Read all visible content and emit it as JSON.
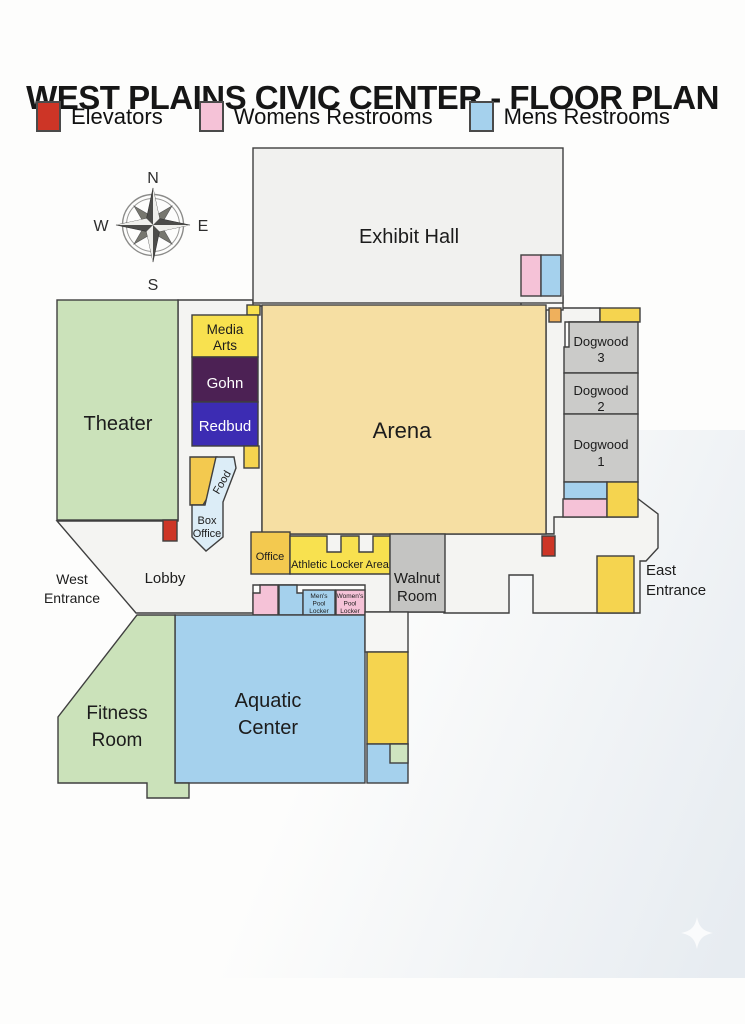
{
  "title": "WEST PLAINS CIVIC CENTER - FLOOR PLAN",
  "legend": {
    "items": [
      {
        "label": "Elevators",
        "color": "#cd3526"
      },
      {
        "label": "Womens Restrooms",
        "color": "#f5c2d7"
      },
      {
        "label": "Mens Restrooms",
        "color": "#a5d1ed"
      }
    ]
  },
  "compass": {
    "north": "N",
    "south": "S",
    "east": "E",
    "west": "W"
  },
  "floorplan": {
    "stroke": "#3f3f3f",
    "shapes": [
      {
        "name": "lobby-area",
        "fill": "#f4f4f2",
        "points": "178,300 253,300 253,306 262,306 262,534 446,534 446,612 365,612 365,585 253,585 253,613 136,613 57,521 178,521"
      },
      {
        "name": "north-right-corridor",
        "fill": "#f4f4f2",
        "points": "546,308 600,308 600,322 565,322 565,534 546,534"
      },
      {
        "name": "east-lobby-area",
        "fill": "#f4f4f2",
        "points": "444,534 554,534 554,517 637,517 637,498 658,514 658,548 646,561 640,561 640,613 533,613 533,575 509,575 509,613 444,613"
      },
      {
        "name": "exhibit-hall-service-box",
        "fill": "#fafaf8",
        "rect": [
          521,
          296,
          42,
          14
        ]
      },
      {
        "name": "exhibit-hall",
        "fill": "#f1f1ef",
        "rect": [
          253,
          148,
          310,
          155
        ]
      },
      {
        "name": "exhibit-womens-restroom",
        "fill": "#f5c2d7",
        "rect": [
          521,
          255,
          20,
          41
        ]
      },
      {
        "name": "exhibit-mens-restroom",
        "fill": "#a5d1ed",
        "rect": [
          541,
          255,
          20,
          41
        ]
      },
      {
        "name": "arena",
        "fill": "#f6dfa3",
        "rect": [
          262,
          305,
          284,
          229
        ]
      },
      {
        "name": "arena-corner-closet",
        "fill": "#efb05c",
        "rect": [
          549,
          308,
          12,
          14
        ]
      },
      {
        "name": "theater",
        "fill": "#cbe2ba",
        "rect": [
          57,
          300,
          121,
          220
        ]
      },
      {
        "name": "media-arts-tab",
        "fill": "#f8e14f",
        "rect": [
          247,
          305,
          13,
          10
        ]
      },
      {
        "name": "media-arts",
        "fill": "#f8e14f",
        "rect": [
          192,
          315,
          66,
          42
        ]
      },
      {
        "name": "gohn",
        "fill": "#4c2154",
        "rect": [
          192,
          357,
          66,
          45
        ]
      },
      {
        "name": "redbud",
        "fill": "#3c2cb3",
        "rect": [
          192,
          402,
          66,
          44
        ]
      },
      {
        "name": "redbud-tab",
        "fill": "#f5d44f",
        "rect": [
          244,
          446,
          15,
          22
        ]
      },
      {
        "name": "concessions",
        "fill": "#f3c94f",
        "points": "190,457 217,457 217,482 203,505 190,505"
      },
      {
        "name": "food-box-office",
        "fill": "#dcedf7",
        "d": "M216,457 L234,457 L236,468 L223,502 L223,537 L206,551 L192,537 L192,505 L205,505 Z"
      },
      {
        "name": "elevator-west",
        "fill": "#cd3526",
        "rect": [
          163,
          520,
          14,
          21
        ]
      },
      {
        "name": "office",
        "fill": "#f3c94f",
        "rect": [
          251,
          532,
          39,
          42
        ]
      },
      {
        "name": "athletic-locker-area",
        "fill": "#f8e14f",
        "points": "290,536 327,536 327,552 341,552 341,536 359,536 359,552 373,552 373,536 390,536 390,574 290,574"
      },
      {
        "name": "walnut-room",
        "fill": "#c4c4c2",
        "rect": [
          390,
          534,
          55,
          78
        ]
      },
      {
        "name": "elevator-east",
        "fill": "#cd3526",
        "rect": [
          542,
          536,
          13,
          20
        ]
      },
      {
        "name": "pool-womens-restroom",
        "fill": "#f5c2d7",
        "points": "253,593 260,593 260,585 278,585 278,615 253,615"
      },
      {
        "name": "pool-mens-restroom",
        "fill": "#a5d1ed",
        "points": "279,585 297,585 297,593 303,593 303,615 279,615"
      },
      {
        "name": "mens-pool-locker",
        "fill": "#a5d1ed",
        "rect": [
          303,
          590,
          32,
          25
        ]
      },
      {
        "name": "womens-pool-locker",
        "fill": "#f5c2d7",
        "rect": [
          336,
          590,
          29,
          25
        ]
      },
      {
        "name": "aquatic-center",
        "fill": "#a5d1ed",
        "rect": [
          175,
          615,
          190,
          168
        ]
      },
      {
        "name": "fitness-room",
        "fill": "#cbe2ba",
        "points": "137,615 175,615 175,783 189,783 189,798 147,798 147,783 58,783 58,717"
      },
      {
        "name": "pool-south-hall",
        "fill": "#f6f6f4",
        "rect": [
          365,
          612,
          43,
          40
        ]
      },
      {
        "name": "pool-south-yellow-room",
        "fill": "#f5d44f",
        "rect": [
          367,
          652,
          41,
          92
        ]
      },
      {
        "name": "pool-south-blue-room",
        "fill": "#a5d1ed",
        "rect": [
          367,
          744,
          41,
          39
        ]
      },
      {
        "name": "pool-south-green-room",
        "fill": "#cfe5c0",
        "rect": [
          390,
          744,
          18,
          19
        ]
      },
      {
        "name": "dogwood-strip",
        "fill": "#f5d44f",
        "rect": [
          600,
          308,
          40,
          14
        ]
      },
      {
        "name": "dogwood-3",
        "fill": "#cbcbc9",
        "points": "569,322 638,322 638,373 564,373 564,347 569,347"
      },
      {
        "name": "dogwood-2",
        "fill": "#cbcbc9",
        "rect": [
          564,
          373,
          74,
          41
        ]
      },
      {
        "name": "dogwood-1",
        "fill": "#cbcbc9",
        "rect": [
          564,
          414,
          74,
          68
        ]
      },
      {
        "name": "dogwood-mens-restroom",
        "fill": "#a5d1ed",
        "rect": [
          564,
          482,
          43,
          17
        ]
      },
      {
        "name": "dogwood-womens-restroom",
        "fill": "#f5c2d7",
        "rect": [
          563,
          499,
          44,
          18
        ]
      },
      {
        "name": "dogwood-yellow-room",
        "fill": "#f5d44f",
        "rect": [
          607,
          482,
          31,
          35
        ]
      },
      {
        "name": "east-entrance-vestibule",
        "fill": "#f5d44f",
        "rect": [
          597,
          556,
          37,
          57
        ]
      }
    ],
    "labels": [
      {
        "name": "exhibit-hall",
        "text": "Exhibit Hall",
        "x": 409,
        "y": 243,
        "size": 20
      },
      {
        "name": "arena",
        "text": "Arena",
        "x": 402,
        "y": 438,
        "size": 22
      },
      {
        "name": "theater",
        "text": "Theater",
        "x": 118,
        "y": 430,
        "size": 20
      },
      {
        "name": "media-arts",
        "lines": [
          "Media",
          "Arts"
        ],
        "x": 225,
        "y": 334,
        "lh": 16,
        "size": 13.5
      },
      {
        "name": "gohn",
        "text": "Gohn",
        "x": 225,
        "y": 388,
        "size": 15,
        "color": "#ffffff"
      },
      {
        "name": "redbud",
        "text": "Redbud",
        "x": 225,
        "y": 431,
        "size": 15,
        "color": "#ffffff"
      },
      {
        "name": "food",
        "text": "Food",
        "x": 225,
        "y": 484,
        "size": 11,
        "rotate": -60
      },
      {
        "name": "box-office",
        "lines": [
          "Box",
          "Office"
        ],
        "x": 207,
        "y": 524,
        "lh": 13,
        "size": 11
      },
      {
        "name": "office",
        "text": "Office",
        "x": 270,
        "y": 560,
        "size": 11
      },
      {
        "name": "athletic-locker-area",
        "text": "Athletic Locker Area",
        "x": 340,
        "y": 568,
        "size": 11
      },
      {
        "name": "walnut-room",
        "lines": [
          "Walnut",
          "Room"
        ],
        "x": 417,
        "y": 583,
        "lh": 18,
        "size": 15
      },
      {
        "name": "lobby",
        "text": "Lobby",
        "x": 165,
        "y": 583,
        "size": 15
      },
      {
        "name": "west-entrance",
        "lines": [
          "West",
          "Entrance"
        ],
        "x": 72,
        "y": 584,
        "lh": 19,
        "size": 14
      },
      {
        "name": "east-entrance",
        "lines": [
          "East",
          "Entrance"
        ],
        "x": 646,
        "y": 575,
        "lh": 20,
        "size": 15,
        "anchor": "start"
      },
      {
        "name": "mens-pool-locker",
        "lines": [
          "Men's",
          "Pool",
          "Locker"
        ],
        "x": 319,
        "y": 598,
        "lh": 7.5,
        "size": 6.5
      },
      {
        "name": "womens-pool-locker",
        "lines": [
          "Women's",
          "Pool",
          "Locker"
        ],
        "x": 350,
        "y": 598,
        "lh": 7.5,
        "size": 6.5
      },
      {
        "name": "aquatic-center",
        "lines": [
          "Aquatic",
          "Center"
        ],
        "x": 268,
        "y": 707,
        "lh": 27,
        "size": 20
      },
      {
        "name": "fitness-room",
        "lines": [
          "Fitness",
          "Room"
        ],
        "x": 117,
        "y": 719,
        "lh": 27,
        "size": 19
      },
      {
        "name": "dogwood-3",
        "lines": [
          "Dogwood",
          "3"
        ],
        "x": 601,
        "y": 346,
        "lh": 16,
        "size": 13
      },
      {
        "name": "dogwood-2",
        "lines": [
          "Dogwood",
          "2"
        ],
        "x": 601,
        "y": 395,
        "lh": 16,
        "size": 13
      },
      {
        "name": "dogwood-1",
        "lines": [
          "Dogwood",
          "1"
        ],
        "x": 601,
        "y": 449,
        "lh": 17,
        "size": 13
      }
    ]
  }
}
